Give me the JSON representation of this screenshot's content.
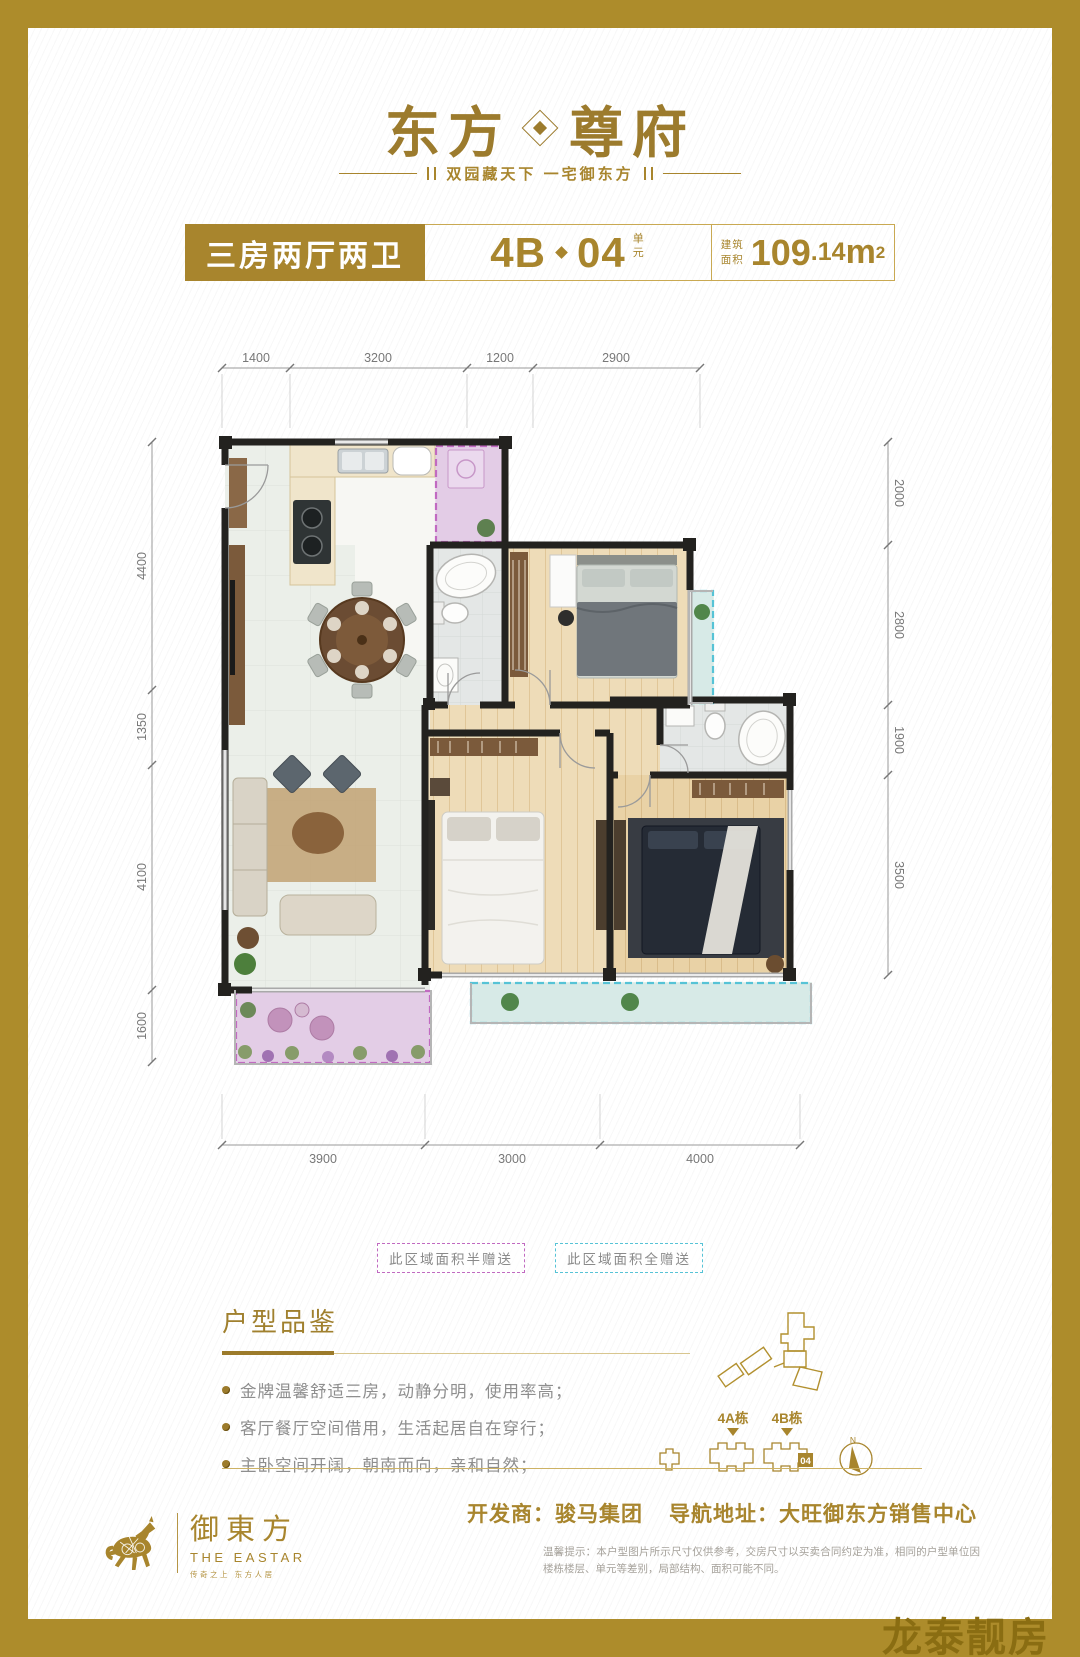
{
  "header": {
    "logo_left": "东方",
    "logo_right": "尊府",
    "tagline": "双园藏天下 一宅御东方"
  },
  "title_bar": {
    "type_label": "三房两厅两卫",
    "unit_prefix": "4B",
    "unit_number": "04",
    "unit_suffix": "单元",
    "area_label_top": "建筑",
    "area_label_bottom": "面积",
    "area_int": "109",
    "area_dec": ".14",
    "area_unit": "m",
    "area_sup": "2"
  },
  "plan": {
    "dims_top": [
      "1400",
      "3200",
      "1200",
      "2900"
    ],
    "dims_left": [
      "4400",
      "1350",
      "4100",
      "1600"
    ],
    "dims_right": [
      "2000",
      "2800",
      "1900",
      "3500"
    ],
    "dims_bottom": [
      "3900",
      "3000",
      "4000"
    ],
    "legend_half": "此区域面积半赠送",
    "legend_full": "此区域面积全赠送"
  },
  "review": {
    "title": "户型品鉴",
    "bullets": [
      "金牌温馨舒适三房，动静分明，使用率高；",
      "客厅餐厅空间借用，生活起居自在穿行；",
      "主卧空间开阔，朝南而向，亲和自然；"
    ]
  },
  "site": {
    "label_4a": "4A栋",
    "label_4b": "4B栋",
    "unit_badge": "04",
    "compass_n": "N"
  },
  "footer": {
    "brand_cn": "御東方",
    "brand_en": "THE EASTAR",
    "brand_slogan": "传奇之上 东方人居",
    "developer": "开发商：骏马集团",
    "address": "导航地址：大旺御东方销售中心",
    "disclaimer": "温馨提示：本户型图片所示尺寸仅供参考，交房尺寸以买卖合同约定为准，相同的户型单位因楼栋楼层、单元等差别，局部结构、面积可能不同。"
  },
  "watermark": "龙泰靓房",
  "colors": {
    "gold": "#ad8c2b",
    "gold_dark": "#8a6d12",
    "purple": "#c16ac1",
    "cyan": "#56c3d6"
  }
}
